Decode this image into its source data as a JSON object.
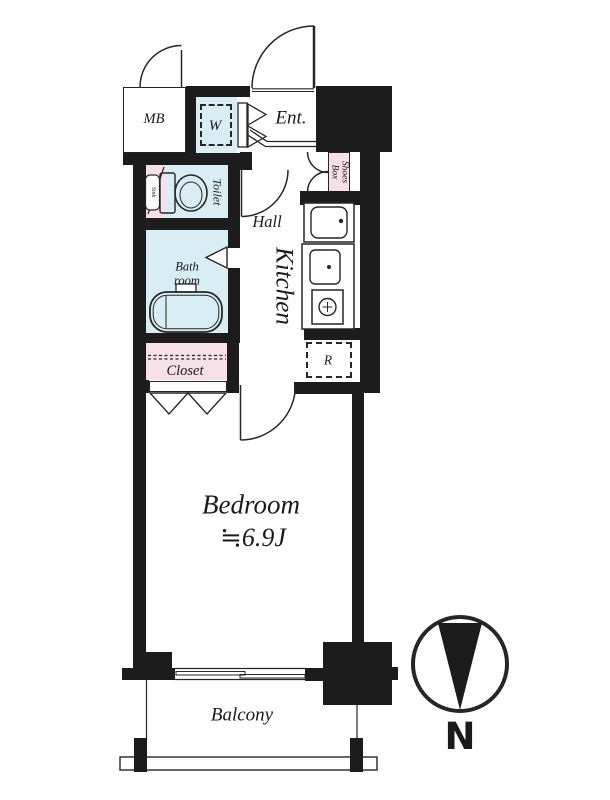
{
  "labels": {
    "mb": "MB",
    "washer": "W",
    "entrance": "Ent.",
    "shoes_box_l1": "Shoes",
    "shoes_box_l2": "Box",
    "toilet": "Toilet",
    "sink": "Sink",
    "hall": "Hall",
    "kitchen": "Kitchen",
    "bath_l1": "Bath",
    "bath_l2": "room",
    "closet": "Closet",
    "fridge": "R",
    "bedroom": "Bedroom",
    "bedroom_size": "≒6.9J",
    "balcony": "Balcony",
    "compass_north": "N"
  },
  "colors": {
    "wall": "#1c1c1c",
    "line": "#262626",
    "wet_area": "#d9edf4",
    "storage": "#f7e0e8",
    "bg": "#ffffff",
    "text": "#1a1a1a"
  }
}
